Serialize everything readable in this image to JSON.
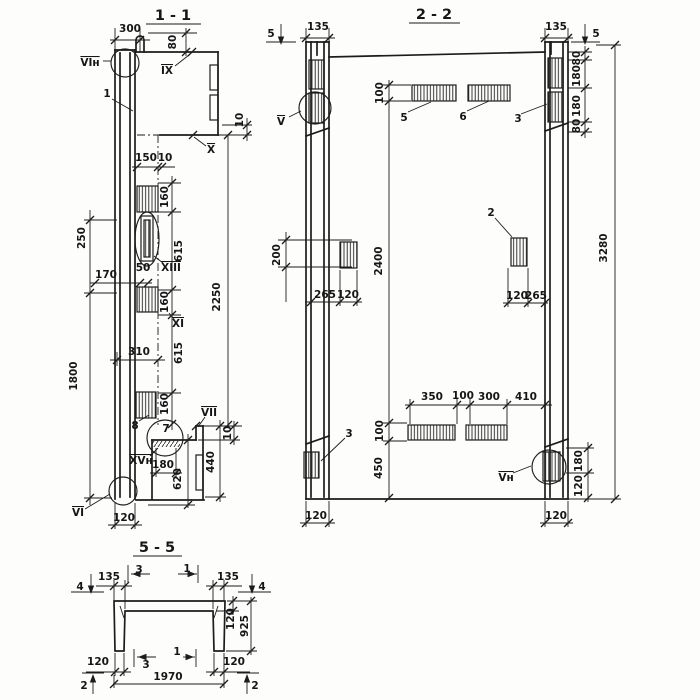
{
  "sections": {
    "s11": {
      "title": "1 - 1",
      "labels": [
        {
          "t": "300",
          "x": 130,
          "y": 29
        },
        {
          "t": "80",
          "x": 173,
          "y": 42,
          "r": -90
        },
        {
          "t": "VIн",
          "x": 90,
          "y": 63,
          "ol": 1,
          "fs": 11,
          "n": "detail-mark"
        },
        {
          "t": "1",
          "x": 107,
          "y": 94,
          "n": "part-number"
        },
        {
          "t": "IX",
          "x": 167,
          "y": 71,
          "ol": 1,
          "fs": 11,
          "n": "detail-mark"
        },
        {
          "t": "X",
          "x": 211,
          "y": 150,
          "ol": 1,
          "fs": 11,
          "n": "detail-mark"
        },
        {
          "t": "10",
          "x": 240,
          "y": 120,
          "r": -90
        },
        {
          "t": "150",
          "x": 146,
          "y": 158
        },
        {
          "t": "10",
          "x": 165,
          "y": 158
        },
        {
          "t": "160",
          "x": 165,
          "y": 197,
          "r": -90
        },
        {
          "t": "615",
          "x": 179,
          "y": 251,
          "r": -90
        },
        {
          "t": "XIII",
          "x": 171,
          "y": 268,
          "ol": 1,
          "fs": 10,
          "n": "detail-mark"
        },
        {
          "t": "50",
          "x": 143,
          "y": 268,
          "fs": 9
        },
        {
          "t": "170",
          "x": 106,
          "y": 275
        },
        {
          "t": "250",
          "x": 82,
          "y": 238,
          "r": -90
        },
        {
          "t": "160",
          "x": 165,
          "y": 302,
          "r": -90
        },
        {
          "t": "XI",
          "x": 178,
          "y": 324,
          "ol": 1,
          "fs": 11,
          "n": "detail-mark"
        },
        {
          "t": "615",
          "x": 179,
          "y": 353,
          "r": -90
        },
        {
          "t": "310",
          "x": 139,
          "y": 352
        },
        {
          "t": "1800",
          "x": 74,
          "y": 376,
          "r": -90
        },
        {
          "t": "160",
          "x": 165,
          "y": 404,
          "r": -90
        },
        {
          "t": "2250",
          "x": 217,
          "y": 297,
          "r": -90
        },
        {
          "t": "8",
          "x": 135,
          "y": 426,
          "n": "part-number"
        },
        {
          "t": "7",
          "x": 166,
          "y": 429,
          "n": "part-number"
        },
        {
          "t": "VII",
          "x": 209,
          "y": 413,
          "ol": 1,
          "fs": 11,
          "n": "detail-mark"
        },
        {
          "t": "10",
          "x": 228,
          "y": 433,
          "r": -90
        },
        {
          "t": "440",
          "x": 211,
          "y": 462,
          "r": -90
        },
        {
          "t": "620",
          "x": 178,
          "y": 479,
          "r": -90
        },
        {
          "t": "XVн",
          "x": 141,
          "y": 461,
          "ol": 1,
          "fs": 10,
          "n": "detail-mark"
        },
        {
          "t": "180",
          "x": 163,
          "y": 465
        },
        {
          "t": "VI",
          "x": 78,
          "y": 513,
          "ol": 1,
          "fs": 11,
          "n": "detail-mark"
        },
        {
          "t": "120",
          "x": 124,
          "y": 518
        }
      ]
    },
    "s22": {
      "title": "2 - 2",
      "labels": [
        {
          "t": "135",
          "x": 318,
          "y": 27
        },
        {
          "t": "5",
          "x": 271,
          "y": 34,
          "n": "section-cut-label"
        },
        {
          "t": "135",
          "x": 556,
          "y": 27
        },
        {
          "t": "5",
          "x": 596,
          "y": 34,
          "n": "section-cut-label"
        },
        {
          "t": "V",
          "x": 281,
          "y": 122,
          "ol": 1,
          "fs": 11,
          "n": "detail-mark"
        },
        {
          "t": "3",
          "x": 518,
          "y": 119,
          "n": "part-number"
        },
        {
          "t": "80",
          "x": 577,
          "y": 58,
          "r": -90
        },
        {
          "t": "180",
          "x": 577,
          "y": 76,
          "r": -90
        },
        {
          "t": "180",
          "x": 577,
          "y": 106,
          "r": -90
        },
        {
          "t": "80",
          "x": 577,
          "y": 126,
          "r": -90
        },
        {
          "t": "100",
          "x": 380,
          "y": 93,
          "r": -90
        },
        {
          "t": "5",
          "x": 404,
          "y": 118,
          "n": "part-number"
        },
        {
          "t": "6",
          "x": 463,
          "y": 117,
          "n": "part-number"
        },
        {
          "t": "2",
          "x": 491,
          "y": 213,
          "n": "part-number"
        },
        {
          "t": "200",
          "x": 277,
          "y": 255,
          "r": -90
        },
        {
          "t": "2400",
          "x": 379,
          "y": 261,
          "r": -90
        },
        {
          "t": "3280",
          "x": 604,
          "y": 248,
          "r": -90
        },
        {
          "t": "265",
          "x": 325,
          "y": 295
        },
        {
          "t": "120",
          "x": 348,
          "y": 295
        },
        {
          "t": "120",
          "x": 517,
          "y": 296
        },
        {
          "t": "265",
          "x": 536,
          "y": 296
        },
        {
          "t": "3",
          "x": 349,
          "y": 434,
          "n": "part-number"
        },
        {
          "t": "350",
          "x": 432,
          "y": 397
        },
        {
          "t": "100",
          "x": 463,
          "y": 396
        },
        {
          "t": "300",
          "x": 489,
          "y": 397
        },
        {
          "t": "410",
          "x": 526,
          "y": 397
        },
        {
          "t": "100",
          "x": 380,
          "y": 431,
          "r": -90
        },
        {
          "t": "450",
          "x": 379,
          "y": 468,
          "r": -90
        },
        {
          "t": "Vн",
          "x": 506,
          "y": 478,
          "ol": 1,
          "fs": 11,
          "n": "detail-mark"
        },
        {
          "t": "180",
          "x": 579,
          "y": 461,
          "r": -90
        },
        {
          "t": "120",
          "x": 579,
          "y": 486,
          "r": -90
        },
        {
          "t": "120",
          "x": 316,
          "y": 516
        },
        {
          "t": "120",
          "x": 556,
          "y": 516
        }
      ]
    },
    "s55": {
      "title": "5 - 5",
      "labels": [
        {
          "t": "4",
          "x": 80,
          "y": 587,
          "n": "section-cut-label"
        },
        {
          "t": "135",
          "x": 109,
          "y": 577
        },
        {
          "t": "3",
          "x": 139,
          "y": 570,
          "n": "section-cut-label"
        },
        {
          "t": "1",
          "x": 187,
          "y": 569,
          "n": "section-cut-label"
        },
        {
          "t": "135",
          "x": 228,
          "y": 577
        },
        {
          "t": "4",
          "x": 262,
          "y": 587,
          "n": "section-cut-label"
        },
        {
          "t": "120",
          "x": 231,
          "y": 619,
          "r": -90
        },
        {
          "t": "925",
          "x": 245,
          "y": 626,
          "r": -90
        },
        {
          "t": "120",
          "x": 98,
          "y": 662
        },
        {
          "t": "3",
          "x": 146,
          "y": 665,
          "n": "section-cut-label"
        },
        {
          "t": "1",
          "x": 177,
          "y": 652,
          "n": "section-cut-label"
        },
        {
          "t": "120",
          "x": 234,
          "y": 662
        },
        {
          "t": "1970",
          "x": 168,
          "y": 677
        },
        {
          "t": "2",
          "x": 84,
          "y": 686,
          "n": "section-cut-label"
        },
        {
          "t": "2",
          "x": 255,
          "y": 686,
          "n": "section-cut-label"
        }
      ]
    }
  }
}
